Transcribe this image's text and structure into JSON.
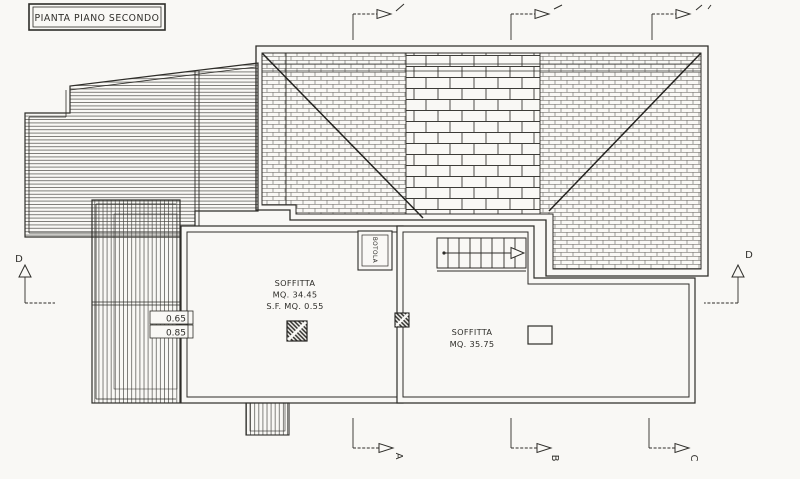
{
  "title": "PIANTA PIANO SECONDO",
  "rooms": {
    "left": {
      "name": "SOFFITTA",
      "area": "MQ. 34.45",
      "sf": "S.F. MQ. 0.55"
    },
    "right": {
      "name": "SOFFITTA",
      "area": "MQ. 35.75"
    }
  },
  "labels": {
    "botola": "BOTOLA",
    "dim_top": "0.65",
    "dim_bottom": "0.85"
  },
  "markers": {
    "bottom": [
      "A",
      "B",
      "C"
    ],
    "side": "D"
  },
  "colors": {
    "ink": "#2e2d29",
    "paper": "#f9f8f5"
  }
}
